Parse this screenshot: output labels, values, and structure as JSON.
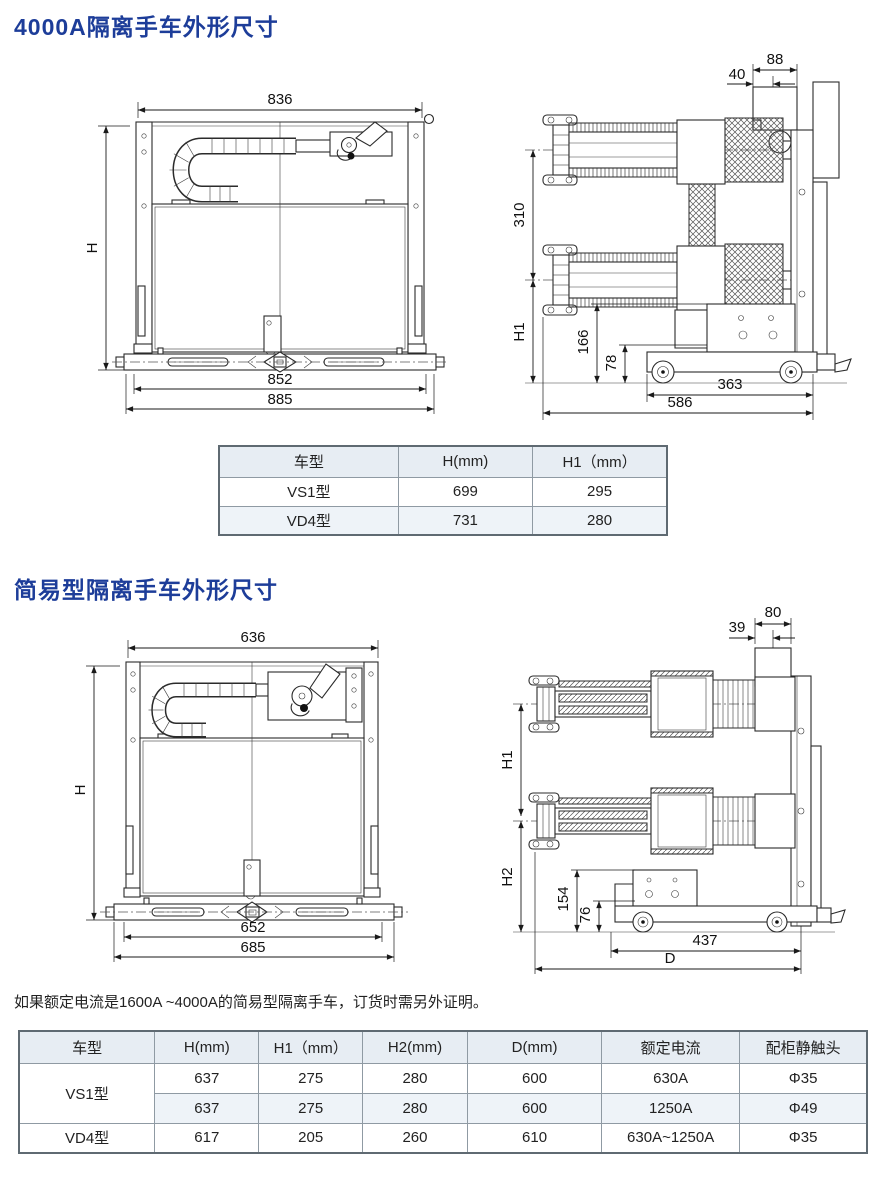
{
  "page": {
    "section1_title": "4000A隔离手车外形尺寸",
    "section2_title": "简易型隔离手车外形尺寸",
    "note": "如果额定电流是1600A ~4000A的简易型隔离手车，订货时需另外证明。",
    "title_color": "#1d3d99",
    "table_header_bg": "#e7edf3",
    "table_alt_row_bg": "#eef3f8"
  },
  "drawings": {
    "front4000": {
      "width_top": "836",
      "height_label": "H",
      "width_rail": "852",
      "width_overall": "885"
    },
    "side4000": {
      "offset_small": "40",
      "offset_large": "88",
      "pole_spacing": "310",
      "h1_label": "H1",
      "bracket_height": "166",
      "base_height": "78",
      "depth_inner": "363",
      "depth_overall": "586"
    },
    "front_simple": {
      "width_top": "636",
      "height_label": "H",
      "width_rail": "652",
      "width_overall": "685"
    },
    "side_simple": {
      "offset_small": "39",
      "offset_large": "80",
      "h1_label": "H1",
      "h2_label": "H2",
      "bracket_height": "154",
      "base_height": "76",
      "depth_inner": "437",
      "depth_overall": "D"
    }
  },
  "table1": {
    "headers": [
      "车型",
      "H(mm)",
      "H1（mm）"
    ],
    "rows": [
      [
        "VS1型",
        "699",
        "295"
      ],
      [
        "VD4型",
        "731",
        "280"
      ]
    ]
  },
  "table2": {
    "headers": [
      "车型",
      "H(mm)",
      "H1（mm）",
      "H2(mm)",
      "D(mm)",
      "额定电流",
      "配柜静触头"
    ],
    "rows": [
      [
        "VS1型",
        "637",
        "275",
        "280",
        "600",
        "630A",
        "Φ35"
      ],
      [
        "637",
        "275",
        "280",
        "600",
        "1250A",
        "Φ49"
      ],
      [
        "VD4型",
        "617",
        "205",
        "260",
        "610",
        "630A~1250A",
        "Φ35"
      ]
    ]
  }
}
